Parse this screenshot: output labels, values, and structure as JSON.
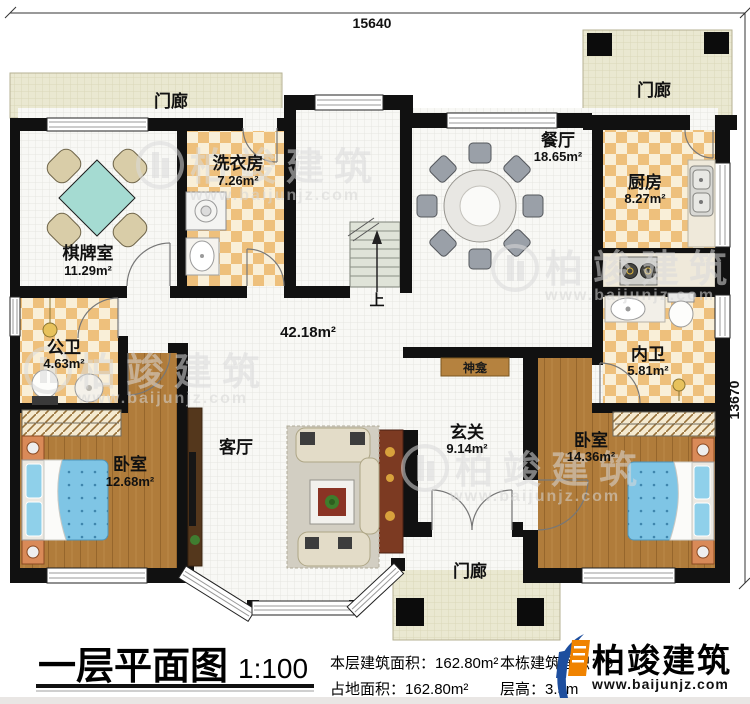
{
  "dimensions": {
    "top_width": "15640",
    "right_height": "13670"
  },
  "rooms": {
    "porch_top": {
      "name": "门廊"
    },
    "porch_right": {
      "name": "门廊"
    },
    "porch_bottom": {
      "name": "门廊"
    },
    "chess_room": {
      "name": "棋牌室",
      "area": "11.29m²"
    },
    "laundry": {
      "name": "洗衣房",
      "area": "7.26m²"
    },
    "dining": {
      "name": "餐厅",
      "area": "18.65m²"
    },
    "kitchen": {
      "name": "厨房",
      "area": "8.27m²"
    },
    "public_bath": {
      "name": "公卫",
      "area": "4.63m²"
    },
    "inner_bath": {
      "name": "内卫",
      "area": "5.81m²"
    },
    "bedroom_left": {
      "name": "卧室",
      "area": "12.68m²"
    },
    "bedroom_right": {
      "name": "卧室",
      "area": "14.36m²"
    },
    "living": {
      "name": "客厅"
    },
    "foyer": {
      "name": "玄关",
      "area": "9.14m²"
    },
    "shrine": {
      "name": "神龛"
    },
    "hall_area": "42.18m²",
    "stairs": {
      "label": "上"
    }
  },
  "title_block": {
    "title": "一层平面图",
    "scale": "1:100",
    "floor_area_label": "本层建筑面积：",
    "floor_area_value": "162.80m²",
    "land_area_label": "占地面积：",
    "land_area_value": "162.80m²",
    "total_area_label": "本栋建筑面积：",
    "total_area_value_partial": "9",
    "storey_height_label": "层高：",
    "storey_height_value": "3.5m"
  },
  "branding": {
    "logo_text": "柏竣建筑",
    "logo_url": "www.baijunjz.com",
    "logo_blue": "#1d4e9e",
    "logo_orange": "#f08300"
  },
  "watermark": {
    "text": "柏竣建筑",
    "url": "www.baijunjz.com"
  },
  "colors": {
    "wall": "#111111",
    "checker_tan": "#eec07c",
    "checker_cream": "#f9efd8",
    "wood": "#b07c3b",
    "porch_floor": "#eae8d1",
    "bed_blue": "#7fc5e5",
    "chess_table_teal": "#a5dbd2"
  }
}
